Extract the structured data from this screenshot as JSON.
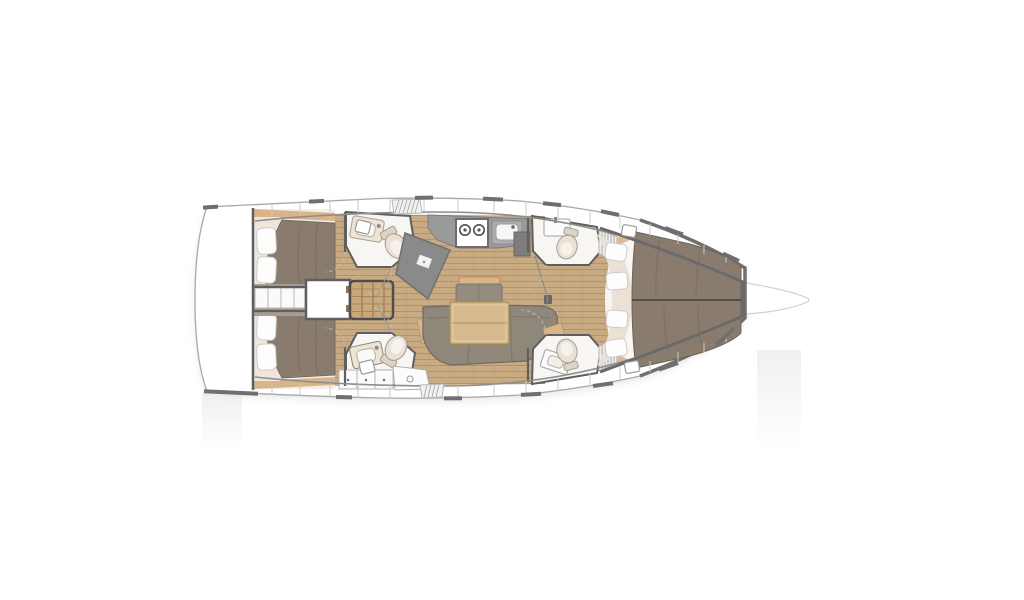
{
  "diagram": {
    "name": "sailing-yacht-interior-floor-plan",
    "orientation": "bow-right",
    "rooms": [
      "aft-cabin-port",
      "aft-cabin-starboard",
      "engine-compartment",
      "companionway-steps",
      "aft-head-port",
      "aft-head-starboard",
      "chart-table",
      "galley",
      "salon-dinette",
      "forward-head-port",
      "forward-head-starboard",
      "forward-cabin",
      "bow"
    ]
  },
  "palette": {
    "page-bg": "#ffffff",
    "hull-fill": "#ffffff",
    "sheer-line": "#a8a8a8",
    "light-line": "#d2d2d2",
    "inner-line": "#8d8d8d",
    "panel-line": "#c9c9c9",
    "wall": "#5f5f5f",
    "dash": "#6f6f6f",
    "room-floor": "#f7f6f3",
    "teak": "#c9ab83",
    "teak-line": "#ab8960",
    "wood-trim": "#d8b488",
    "wood-dark": "#ab8a58",
    "steps-wood": "#c9a87c",
    "bed": "#897c6f",
    "bed-dark": "#6e6358",
    "sheet": "#f2e4da",
    "pillow": "#fdfdfd",
    "pillow-line": "#cbcbcb",
    "cream": "#ece1d5",
    "counter": "#9a9a9a",
    "counter-dark": "#7b7b7b",
    "unit-dark": "#7d7d7d",
    "sofa": "#8f877a",
    "sofa-dark": "#6f6a5e",
    "cushion": "#948c7f",
    "fixture": "#e9e1d6",
    "fixture-line": "#a39c90",
    "taupe-wall": "#a99d92",
    "arc": "#bdbdbd"
  }
}
